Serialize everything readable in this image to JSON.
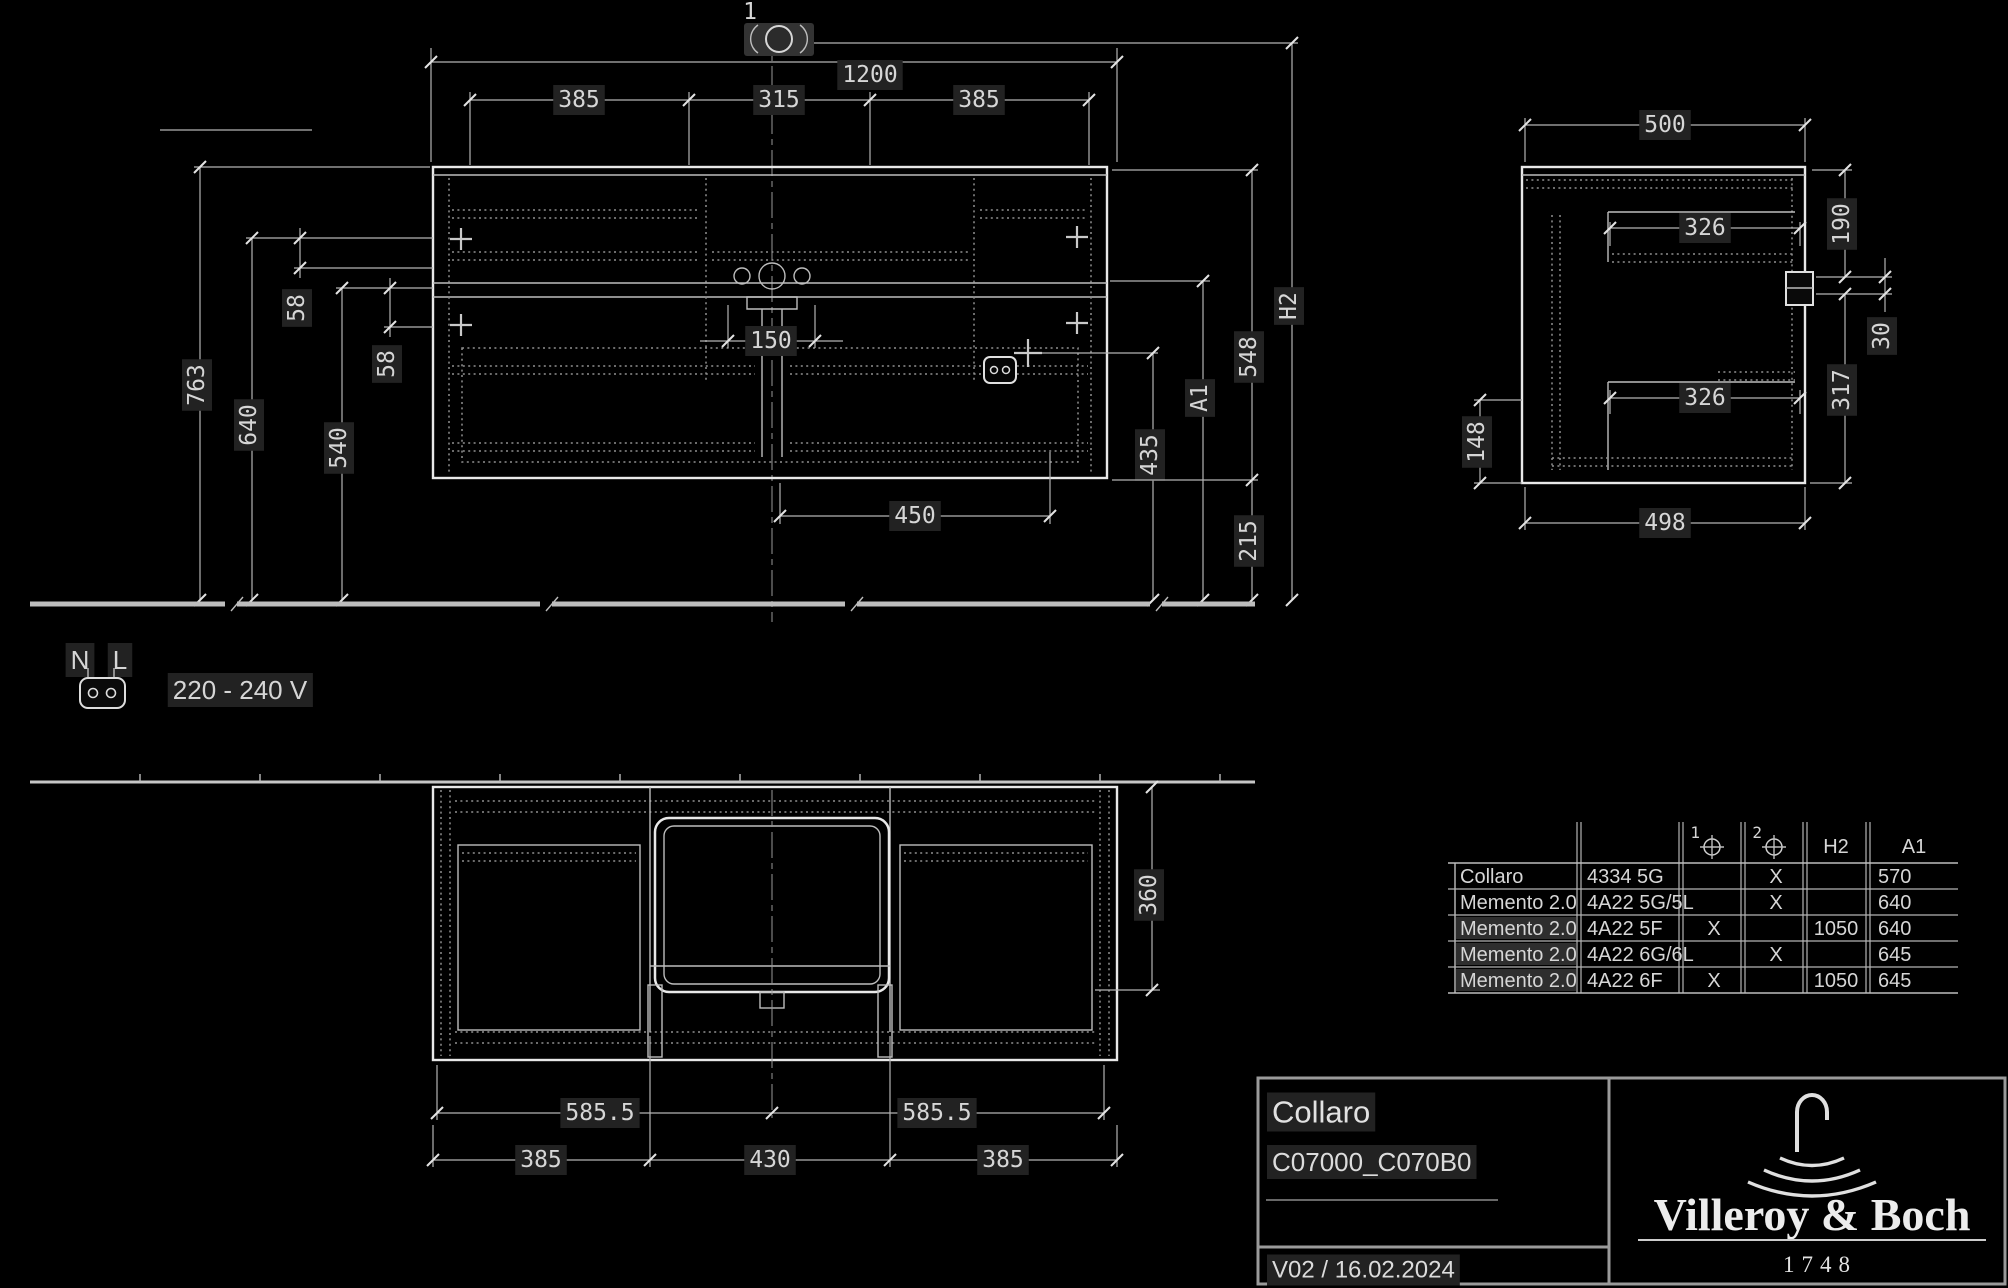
{
  "front_view": {
    "callout_1": "1",
    "dim_width_total": "1200",
    "dim_width_left": "385",
    "dim_width_center": "315",
    "dim_width_right": "385",
    "dim_height_total": "763",
    "dim_height_drawer_top": "640",
    "dim_height_mid": "540",
    "dim_gap_upper": "58",
    "dim_gap_lower": "58",
    "dim_siphon_width": "150",
    "dim_bottom_clearance": "450",
    "dim_socket_height": "435",
    "dim_a1": "A1",
    "dim_cabinet_height": "548",
    "dim_under_height": "215",
    "dim_h2": "H2"
  },
  "side_view": {
    "dim_depth_top": "500",
    "dim_inner_upper": "326",
    "dim_inner_lower": "326",
    "dim_right_upper": "190",
    "dim_right_notch": "30",
    "dim_right_lower": "317",
    "dim_left_bottom": "148",
    "dim_depth_bottom": "498"
  },
  "plan_view": {
    "dim_half_left": "585.5",
    "dim_half_right": "585.5",
    "dim_bottom_left": "385",
    "dim_bottom_center": "430",
    "dim_bottom_right": "385",
    "dim_depth": "360"
  },
  "electrical": {
    "label_n": "N",
    "label_l": "L",
    "voltage": "220 - 240 V"
  },
  "spec_table": {
    "header": {
      "col_pos1": "1",
      "col_pos2": "2",
      "col_h2": "H2",
      "col_a1": "A1"
    },
    "rows": [
      {
        "name": "Collaro",
        "code": "4334 5G",
        "pos1": "",
        "pos2": "X",
        "h2": "",
        "a1": "570"
      },
      {
        "name": "Memento 2.0",
        "code": "4A22 5G/5L",
        "pos1": "",
        "pos2": "X",
        "h2": "",
        "a1": "640"
      },
      {
        "name": "Memento 2.0",
        "code": "4A22 5F",
        "pos1": "X",
        "pos2": "",
        "h2": "1050",
        "a1": "640"
      },
      {
        "name": "Memento 2.0",
        "code": "4A22 6G/6L",
        "pos1": "",
        "pos2": "X",
        "h2": "",
        "a1": "645"
      },
      {
        "name": "Memento 2.0",
        "code": "4A22 6F",
        "pos1": "X",
        "pos2": "",
        "h2": "1050",
        "a1": "645"
      }
    ]
  },
  "title_block": {
    "product_name": "Collaro",
    "product_codes": "C07000_C070B0",
    "version_date": "V02 / 16.02.2024",
    "brand_name": "Villeroy & Boch",
    "brand_year": "1748"
  }
}
